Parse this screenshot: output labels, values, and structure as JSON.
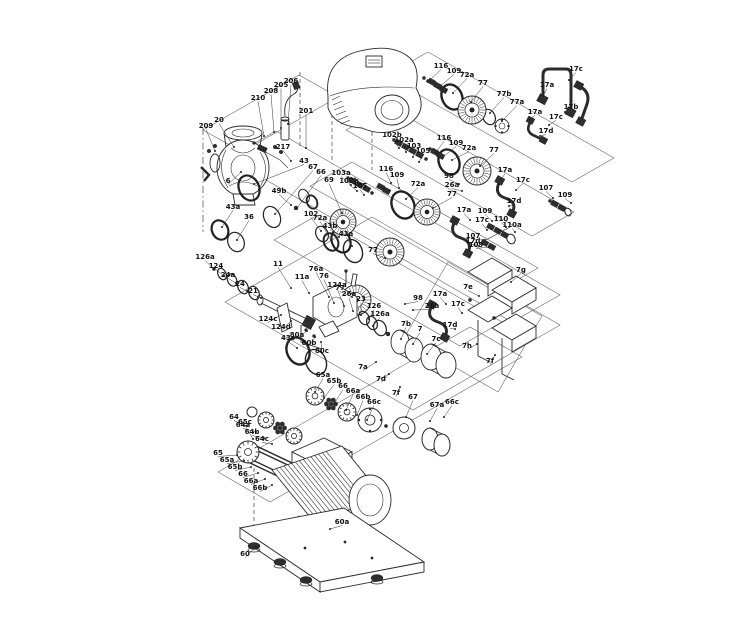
{
  "figure": {
    "kind": "exploded-parts-diagram",
    "subject": "pump assembly with motor, couplings, seal kits and baseplate"
  },
  "style": {
    "background": "#ffffff",
    "line_ink": "#2b2b2b",
    "kit_box_line": "#6a6a6a",
    "label_color": "#111111"
  },
  "callouts": [
    [
      "209",
      206,
      128,
      215,
      151
    ],
    [
      "20",
      219,
      122,
      234,
      147
    ],
    [
      "210",
      258,
      100,
      264,
      136
    ],
    [
      "208",
      271,
      93,
      274,
      132
    ],
    [
      "205",
      281,
      87,
      281,
      128
    ],
    [
      "206",
      291,
      83,
      288,
      124
    ],
    [
      "201",
      306,
      113,
      306,
      148
    ],
    [
      "217",
      283,
      149,
      291,
      161
    ],
    [
      "6",
      228,
      183,
      241,
      172
    ],
    [
      "43a",
      233,
      209,
      222,
      227
    ],
    [
      "36",
      249,
      219,
      237,
      240
    ],
    [
      "43",
      304,
      163,
      254,
      184
    ],
    [
      "67",
      313,
      169,
      275,
      214
    ],
    [
      "66",
      321,
      174,
      297,
      208
    ],
    [
      "69",
      329,
      182,
      342,
      213
    ],
    [
      "49b",
      279,
      193,
      291,
      205
    ],
    [
      "102",
      311,
      216,
      321,
      231
    ],
    [
      "72a",
      320,
      220,
      331,
      240
    ],
    [
      "116",
      441,
      68,
      429,
      81
    ],
    [
      "109",
      454,
      73,
      438,
      88
    ],
    [
      "72a",
      467,
      77,
      453,
      93
    ],
    [
      "77",
      483,
      85,
      471,
      102
    ],
    [
      "77b",
      504,
      96,
      490,
      113
    ],
    [
      "77a",
      517,
      104,
      502,
      121
    ],
    [
      "17a",
      547,
      87,
      543,
      96
    ],
    [
      "17c",
      576,
      71,
      569,
      80
    ],
    [
      "17b",
      571,
      109,
      565,
      112
    ],
    [
      "17a",
      535,
      114,
      530,
      119
    ],
    [
      "17c",
      556,
      119,
      549,
      125
    ],
    [
      "17d",
      546,
      133,
      540,
      136
    ],
    [
      "102b",
      392,
      137,
      399,
      148
    ],
    [
      "102a",
      404,
      142,
      406,
      152
    ],
    [
      "103",
      414,
      148,
      413,
      157
    ],
    [
      "105",
      423,
      153,
      419,
      162
    ],
    [
      "116",
      444,
      140,
      436,
      152
    ],
    [
      "109",
      456,
      145,
      443,
      157
    ],
    [
      "72a",
      469,
      150,
      452,
      160
    ],
    [
      "77",
      494,
      152,
      480,
      166
    ],
    [
      "98",
      449,
      178,
      459,
      184
    ],
    [
      "26a",
      452,
      187,
      462,
      191
    ],
    [
      "17a",
      505,
      172,
      501,
      180
    ],
    [
      "17c",
      523,
      182,
      516,
      190
    ],
    [
      "17d",
      514,
      203,
      509,
      206
    ],
    [
      "103a",
      341,
      175,
      351,
      185
    ],
    [
      "102b",
      349,
      183,
      357,
      191
    ],
    [
      "105",
      360,
      188,
      364,
      195
    ],
    [
      "116",
      386,
      171,
      391,
      183
    ],
    [
      "109",
      397,
      177,
      399,
      188
    ],
    [
      "72a",
      418,
      186,
      406,
      199
    ],
    [
      "77",
      452,
      196,
      433,
      208
    ],
    [
      "17a",
      464,
      212,
      470,
      220
    ],
    [
      "17c",
      482,
      222,
      487,
      230
    ],
    [
      "17d",
      473,
      243,
      479,
      246
    ],
    [
      "109",
      485,
      213,
      492,
      221
    ],
    [
      "110",
      501,
      221,
      506,
      227
    ],
    [
      "110a",
      512,
      227,
      515,
      232
    ],
    [
      "107",
      473,
      238,
      485,
      240
    ],
    [
      "109",
      476,
      247,
      489,
      247
    ],
    [
      "107",
      546,
      190,
      553,
      198
    ],
    [
      "109",
      565,
      197,
      571,
      203
    ],
    [
      "43b",
      330,
      228,
      339,
      237
    ],
    [
      "43a",
      346,
      236,
      352,
      246
    ],
    [
      "43c",
      288,
      340,
      297,
      348
    ],
    [
      "77",
      373,
      252,
      385,
      258
    ],
    [
      "77",
      340,
      290,
      352,
      297
    ],
    [
      "98",
      418,
      300,
      405,
      304
    ],
    [
      "26a",
      432,
      308,
      413,
      310
    ],
    [
      "17a",
      440,
      296,
      446,
      304
    ],
    [
      "17c",
      458,
      306,
      462,
      313
    ],
    [
      "17d",
      450,
      327,
      455,
      329
    ],
    [
      "126a",
      205,
      259,
      214,
      269
    ],
    [
      "124",
      216,
      268,
      224,
      276
    ],
    [
      "24a",
      228,
      277,
      236,
      283
    ],
    [
      "24",
      240,
      286,
      247,
      291
    ],
    [
      "21",
      253,
      293,
      261,
      298
    ],
    [
      "11",
      278,
      266,
      291,
      288
    ],
    [
      "11a",
      302,
      279,
      309,
      293
    ],
    [
      "76a",
      316,
      271,
      329,
      297
    ],
    [
      "76",
      324,
      278,
      334,
      303
    ],
    [
      "124a",
      337,
      287,
      344,
      306
    ],
    [
      "26a",
      349,
      296,
      353,
      311
    ],
    [
      "23",
      361,
      301,
      361,
      315
    ],
    [
      "126",
      374,
      308,
      369,
      319
    ],
    [
      "126a",
      380,
      316,
      373,
      326
    ],
    [
      "124c",
      268,
      321,
      281,
      315
    ],
    [
      "124d",
      281,
      329,
      291,
      321
    ],
    [
      "80a",
      297,
      337,
      307,
      331
    ],
    [
      "80b",
      309,
      345,
      315,
      337
    ],
    [
      "80c",
      322,
      353,
      321,
      342
    ],
    [
      "7b",
      406,
      326,
      401,
      339
    ],
    [
      "7",
      420,
      331,
      413,
      344
    ],
    [
      "7c",
      436,
      341,
      427,
      354
    ],
    [
      "7a",
      363,
      369,
      376,
      362
    ],
    [
      "7d",
      381,
      381,
      389,
      374
    ],
    [
      "7f",
      396,
      395,
      400,
      387
    ],
    [
      "7g",
      521,
      272,
      511,
      282
    ],
    [
      "7e",
      468,
      289,
      479,
      296
    ],
    [
      "7h",
      467,
      348,
      477,
      344
    ],
    [
      "7f",
      490,
      363,
      495,
      355
    ],
    [
      "65a",
      323,
      377,
      315,
      392
    ],
    [
      "65b",
      334,
      383,
      324,
      398
    ],
    [
      "66",
      343,
      388,
      334,
      404
    ],
    [
      "66a",
      353,
      393,
      346,
      410
    ],
    [
      "66b",
      363,
      399,
      357,
      415
    ],
    [
      "66c",
      374,
      404,
      367,
      420
    ],
    [
      "67",
      413,
      399,
      406,
      417
    ],
    [
      "67a",
      437,
      407,
      430,
      421
    ],
    [
      "66c",
      452,
      404,
      444,
      417
    ],
    [
      "64",
      234,
      419,
      247,
      426
    ],
    [
      "64a",
      243,
      427,
      256,
      432
    ],
    [
      "64b",
      252,
      434,
      264,
      438
    ],
    [
      "64c",
      262,
      441,
      272,
      444
    ],
    [
      "65c",
      245,
      424,
      253,
      439
    ],
    [
      "65",
      218,
      455,
      237,
      455
    ],
    [
      "65a",
      227,
      462,
      244,
      461
    ],
    [
      "65b",
      235,
      469,
      251,
      467
    ],
    [
      "66",
      243,
      476,
      258,
      473
    ],
    [
      "66a",
      251,
      483,
      265,
      479
    ],
    [
      "66b",
      260,
      490,
      272,
      485
    ],
    [
      "60a",
      342,
      524,
      330,
      529
    ],
    [
      "60",
      245,
      556,
      256,
      547
    ]
  ]
}
